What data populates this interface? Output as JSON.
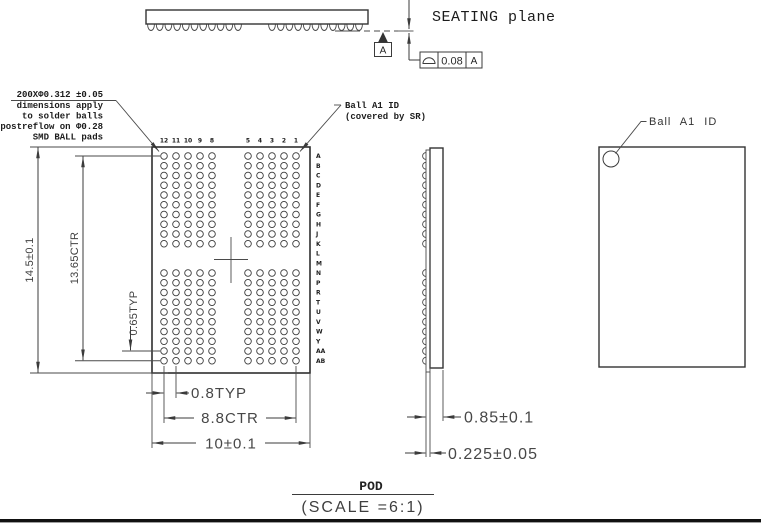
{
  "top_profile": {
    "seating_plane_label": "SEATING plane",
    "datum_flag": "A",
    "fcf": {
      "symbol_name": "surface-profile-icon",
      "tolerance": "0.08",
      "datum_ref": "A"
    }
  },
  "ball_note": {
    "lines": [
      "200XΦ0.312 ±0.05",
      "dimensions apply",
      "to solder balls",
      "postreflow on Φ0.28",
      "SMD BALL pads"
    ]
  },
  "bottom_view": {
    "ball_a1_note": {
      "line1": "Ball A1 ID",
      "line2": "(covered by SR)"
    },
    "column_labels": [
      "12",
      "11",
      "10",
      "9",
      "8",
      "7",
      "6",
      "5",
      "4",
      "3",
      "2",
      "1"
    ],
    "hidden_column_labels": [
      "7",
      "6"
    ],
    "row_labels": [
      "A",
      "B",
      "C",
      "D",
      "E",
      "F",
      "G",
      "H",
      "J",
      "K",
      "L",
      "M",
      "N",
      "P",
      "R",
      "T",
      "U",
      "V",
      "W",
      "Y",
      "AA",
      "AB"
    ],
    "hidden_row_labels": [
      "L",
      "M"
    ],
    "dim_height": "14.5±0.1",
    "dim_rows_ctr": "13.65CTR",
    "dim_row_pitch": "0.65TYP",
    "dim_col_pitch": "0.8TYP",
    "dim_cols_ctr": "8.8CTR",
    "dim_width": "10±0.1"
  },
  "side_view": {
    "dim_body": "0.85±0.1",
    "dim_substrate": "0.225±0.05"
  },
  "top_view_right": {
    "ball_a1_label": "Ball A1 ID"
  },
  "footer": {
    "view_name": "POD",
    "scale": "(SCALE =6:1)"
  },
  "colors": {
    "line": "#3b3b3b",
    "dim_text": "#474747",
    "arrow": "#3b3b3b"
  }
}
